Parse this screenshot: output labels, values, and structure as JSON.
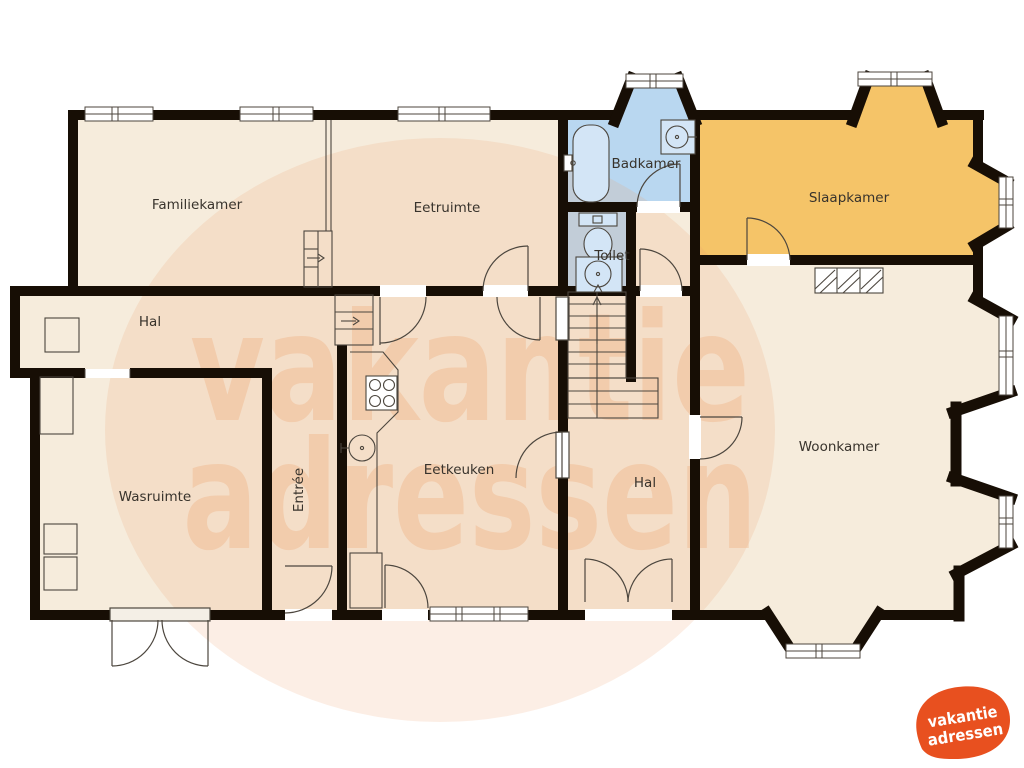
{
  "plan": {
    "rooms": {
      "familiekamer": {
        "label": "Familiekamer"
      },
      "eetruimte": {
        "label": "Eetruimte"
      },
      "badkamer": {
        "label": "Badkamer"
      },
      "toilet": {
        "label": "Toilet"
      },
      "slaapkamer": {
        "label": "Slaapkamer"
      },
      "hal_top": {
        "label": "Hal"
      },
      "wasruimte": {
        "label": "Wasruimte"
      },
      "entree": {
        "label": "Entrée"
      },
      "eetkeuken": {
        "label": "Eetkeuken"
      },
      "hal_center": {
        "label": "Hal"
      },
      "woonkamer": {
        "label": "Woonkamer"
      }
    },
    "colors": {
      "wall": "#170e05",
      "floor": "#f6ecdc",
      "wet_room": "#b9d7f0",
      "fixture_fill": "#d3e5f6",
      "bedroom": "#f5c468",
      "line": "#4c463e"
    },
    "fixtures": [
      "bathtub-icon",
      "sink-icon",
      "toilet-icon",
      "stove-icon",
      "kitchen-sink-icon",
      "staircase-icon",
      "radiator-icon"
    ]
  },
  "watermark": {
    "line1": "vakantie",
    "line2": "adressen",
    "color": "#efa36f"
  },
  "logo": {
    "line1": "vakantie",
    "line2": "adressen",
    "color": "#e8501f",
    "text_color": "#ffffff"
  }
}
